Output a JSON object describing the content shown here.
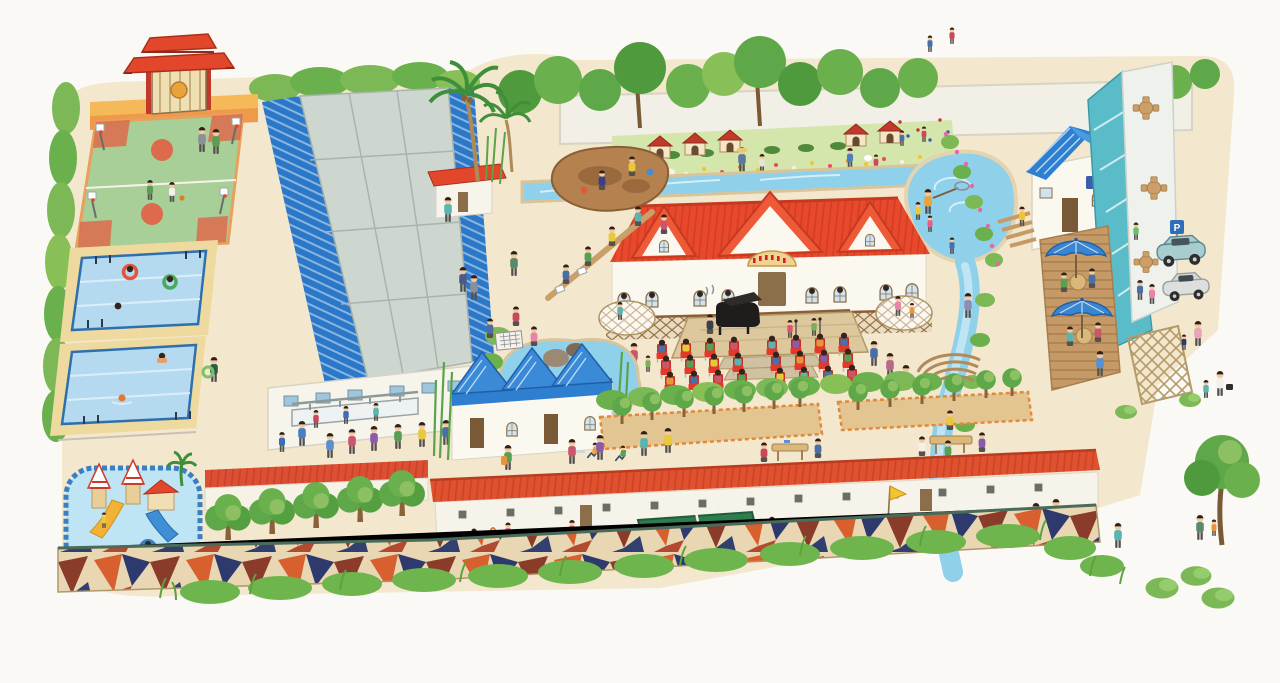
{
  "scene": {
    "title": "Hand-painted bird's-eye illustrated map of an elementary-school campus open day, watercolor storybook style",
    "background_color": "#faf9f5"
  },
  "palette": {
    "ground_sand": "#f3e7cd",
    "hedge_green": "#7cb956",
    "tree_green": "#5fa849",
    "roof_red": "#e8492c",
    "roof_blue": "#2e7fd0",
    "gym_blue": "#2b78c8",
    "water_blue": "#8fd0ea",
    "pool_blue": "#b5daf0",
    "deck_sand": "#eeda9e",
    "chair_red": "#e2392b",
    "mosaic_orange": "#d85f2e",
    "mosaic_navy": "#2e3a6e",
    "plank_brown": "#c59a66"
  },
  "signs": {
    "parking": {
      "label": "P",
      "background": "#2e6fb7",
      "foreground": "#ffffff"
    },
    "hall_plaque": {
      "description": "arched golden plaque with small red characters (illegible at this scale)"
    }
  },
  "areas": [
    {
      "id": "entrance-gate",
      "label": "Red Chinese-style entrance gate in yellow wall"
    },
    {
      "id": "basketball-courts",
      "label": "Two green basketball courts with players"
    },
    {
      "id": "swimming-pools",
      "label": "Two outdoor lap pools with swimmers and ladders"
    },
    {
      "id": "kids-water-playground",
      "label": "Children's water playground with castle slides"
    },
    {
      "id": "gymnasium",
      "label": "Large gymnasium with blue corrugated roof and grey skylights"
    },
    {
      "id": "wash-station",
      "label": "Outdoor wash basins with children washing hands"
    },
    {
      "id": "main-hall",
      "label": "Red-roofed school hall with veranda, gables and plaque"
    },
    {
      "id": "stage",
      "label": "Outdoor wooden stage with grand piano and singing children"
    },
    {
      "id": "audience",
      "label": "Rows of red chairs with seated children and standing adults"
    },
    {
      "id": "rock-pond",
      "label": "Rock pond with fish"
    },
    {
      "id": "sandpit",
      "label": "Sand play area with toddlers and buckets"
    },
    {
      "id": "board-game",
      "label": "People playing a board game on the ground"
    },
    {
      "id": "flower-garden",
      "label": "Flower and vegetable garden with red-roofed animal coops, chickens and rabbits"
    },
    {
      "id": "climbing-wall",
      "label": "Children climbing holds on the white wall"
    },
    {
      "id": "fishing-pond",
      "label": "Pond with a man scooping fish with a net"
    },
    {
      "id": "stream",
      "label": "Blue stream winding from the garden down the east side"
    },
    {
      "id": "foot-bridge",
      "label": "Curved stepped footbridge over the stream"
    },
    {
      "id": "cottages",
      "label": "White cottages with blue gable roofs and bamboo"
    },
    {
      "id": "tree-planters",
      "label": "Raised tan planters with tree groves and tea tables"
    },
    {
      "id": "classroom-row",
      "label": "Long single-storey classroom building with red roof"
    },
    {
      "id": "ping-pong",
      "label": "Green table-tennis table with two players"
    },
    {
      "id": "relay-race",
      "label": "Relay runners, flag referee and cheering spectators"
    },
    {
      "id": "jianzi-game",
      "label": "Children kicking a shuttlecock"
    },
    {
      "id": "mosaic-wall",
      "label": "Colorful geometric mosaic retaining wall with grass fringe"
    },
    {
      "id": "orchard",
      "label": "Row of round fruit trees along a red-capped wall"
    },
    {
      "id": "cafe-deck",
      "label": "Wooden cafe deck with two blue parasols and wicker seats"
    },
    {
      "id": "glass-pavilion",
      "label": "Teal glass pavilion with white terrace and wooden table sets"
    },
    {
      "id": "trellis",
      "label": "Wooden lattice trellis with shrubs"
    },
    {
      "id": "parking",
      "label": "Parking bay with P sign, a teal minivan and a silver car"
    }
  ]
}
